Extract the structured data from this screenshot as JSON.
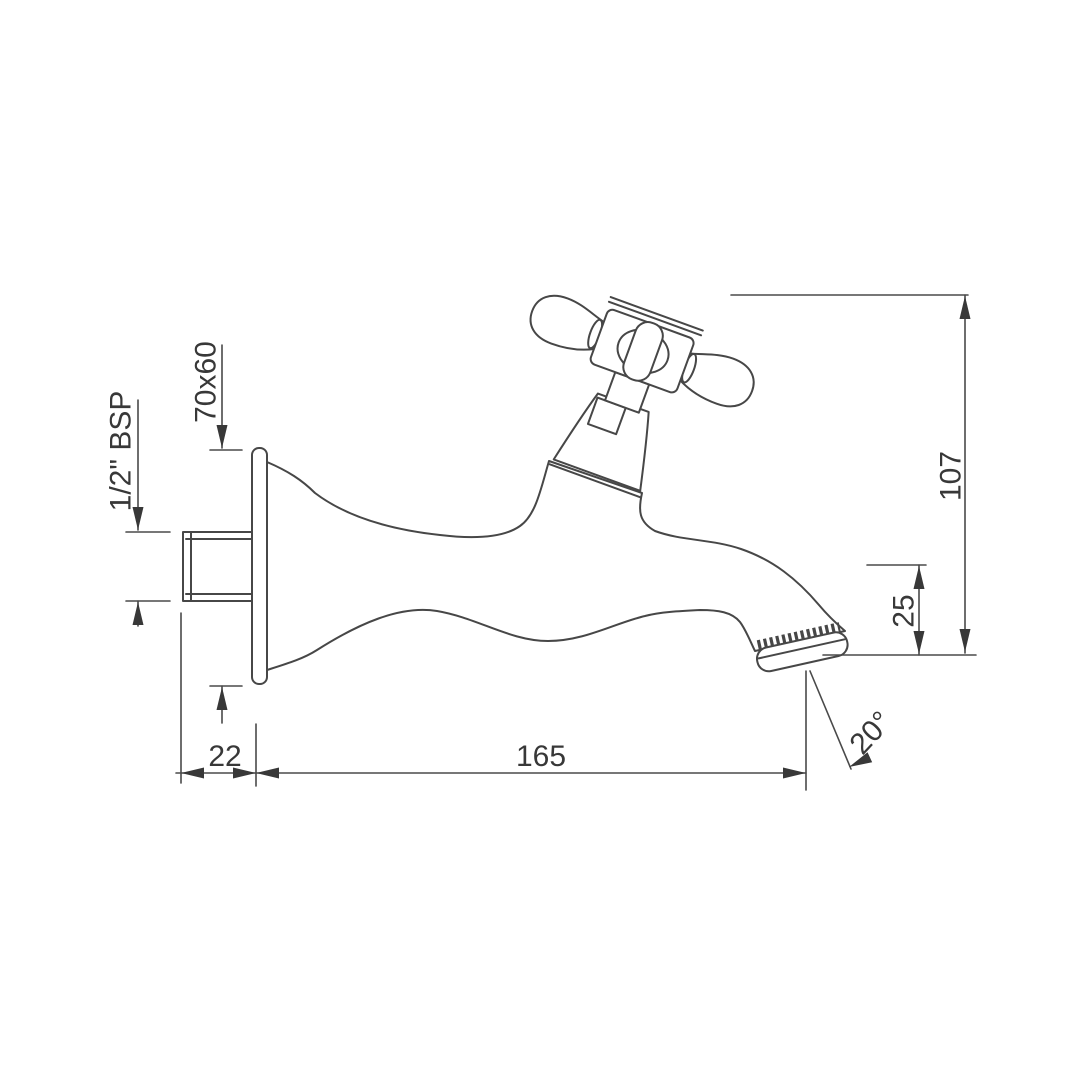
{
  "canvas": {
    "width": 1080,
    "height": 1080,
    "background": "#ffffff"
  },
  "drawing": {
    "style": {
      "line_color": "#474747",
      "dimension_color": "#4a4a4a",
      "text_color": "#383838"
    },
    "dimensions": {
      "flange_size": "70x60",
      "inlet_thread": "1/2\" BSP",
      "overall_height": "107",
      "tip_drop": "25",
      "thread_length": "22",
      "spout_reach": "165",
      "spout_angle": "20°"
    }
  }
}
